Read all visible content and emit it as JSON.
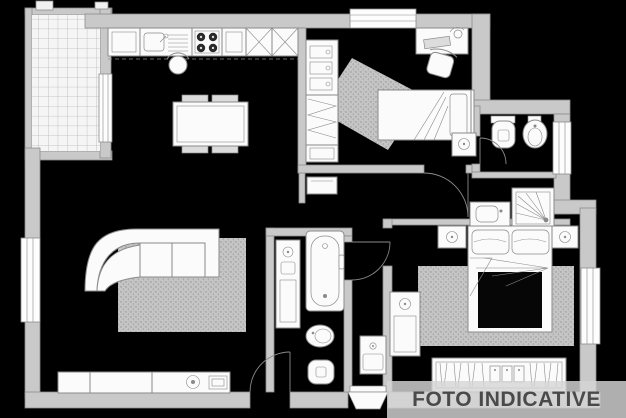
{
  "watermark": {
    "text": "FOTO INDICATIVE"
  },
  "colors": {
    "background": "#000000",
    "wall-fill": "#c9c9c9",
    "wall-edge": "#8d8d8d",
    "line": "#8a8a8a",
    "furniture-fill": "#fbfbfb",
    "watermark-bg": "rgba(214,214,214,0.82)",
    "watermark-text": "#4a4a4a"
  },
  "plan": {
    "type": "apartment-floor-plan",
    "rooms": [
      {
        "name": "balcony",
        "features": [
          "tiled-floor",
          "opening-to-living-room"
        ]
      },
      {
        "name": "living-room-kitchen",
        "furniture": [
          "kitchen-counter",
          "kitchen-sink",
          "stove-4-burners",
          "kitchen-cabinets",
          "tall-units-x",
          "stool",
          "dining-table",
          "four-chairs",
          "sectional-sofa",
          "rug",
          "tv-sideboard",
          "speaker",
          "tv"
        ]
      },
      {
        "name": "bedroom-2",
        "furniture": [
          "single-bed",
          "pillow",
          "desk",
          "desk-chair",
          "desk-lamp",
          "wardrobe-drawers",
          "nightstand",
          "diagonal-rug"
        ]
      },
      {
        "name": "bathroom-2",
        "furniture": [
          "toilet",
          "bidet"
        ]
      },
      {
        "name": "shower-room",
        "furniture": [
          "shower",
          "washbasin-cabinet"
        ]
      },
      {
        "name": "main-bathroom",
        "furniture": [
          "washbasin-cabinet",
          "bathtub",
          "bidet",
          "toilet"
        ]
      },
      {
        "name": "hallway",
        "furniture": [
          "shoe-cabinet",
          "washing-machine"
        ]
      },
      {
        "name": "master-bedroom",
        "furniture": [
          "double-bed",
          "two-pillows",
          "nightstand-left",
          "nightstand-right",
          "dresser",
          "wardrobe-with-hangers",
          "rug"
        ]
      }
    ],
    "doors": [
      "entrance-door",
      "hall-door",
      "main-bathroom-door",
      "bathroom-2-door",
      "balcony-opening",
      "corridor-entrance"
    ],
    "windows": [
      "top-window",
      "left-window",
      "bathroom-2-window",
      "master-bedroom-window"
    ]
  }
}
